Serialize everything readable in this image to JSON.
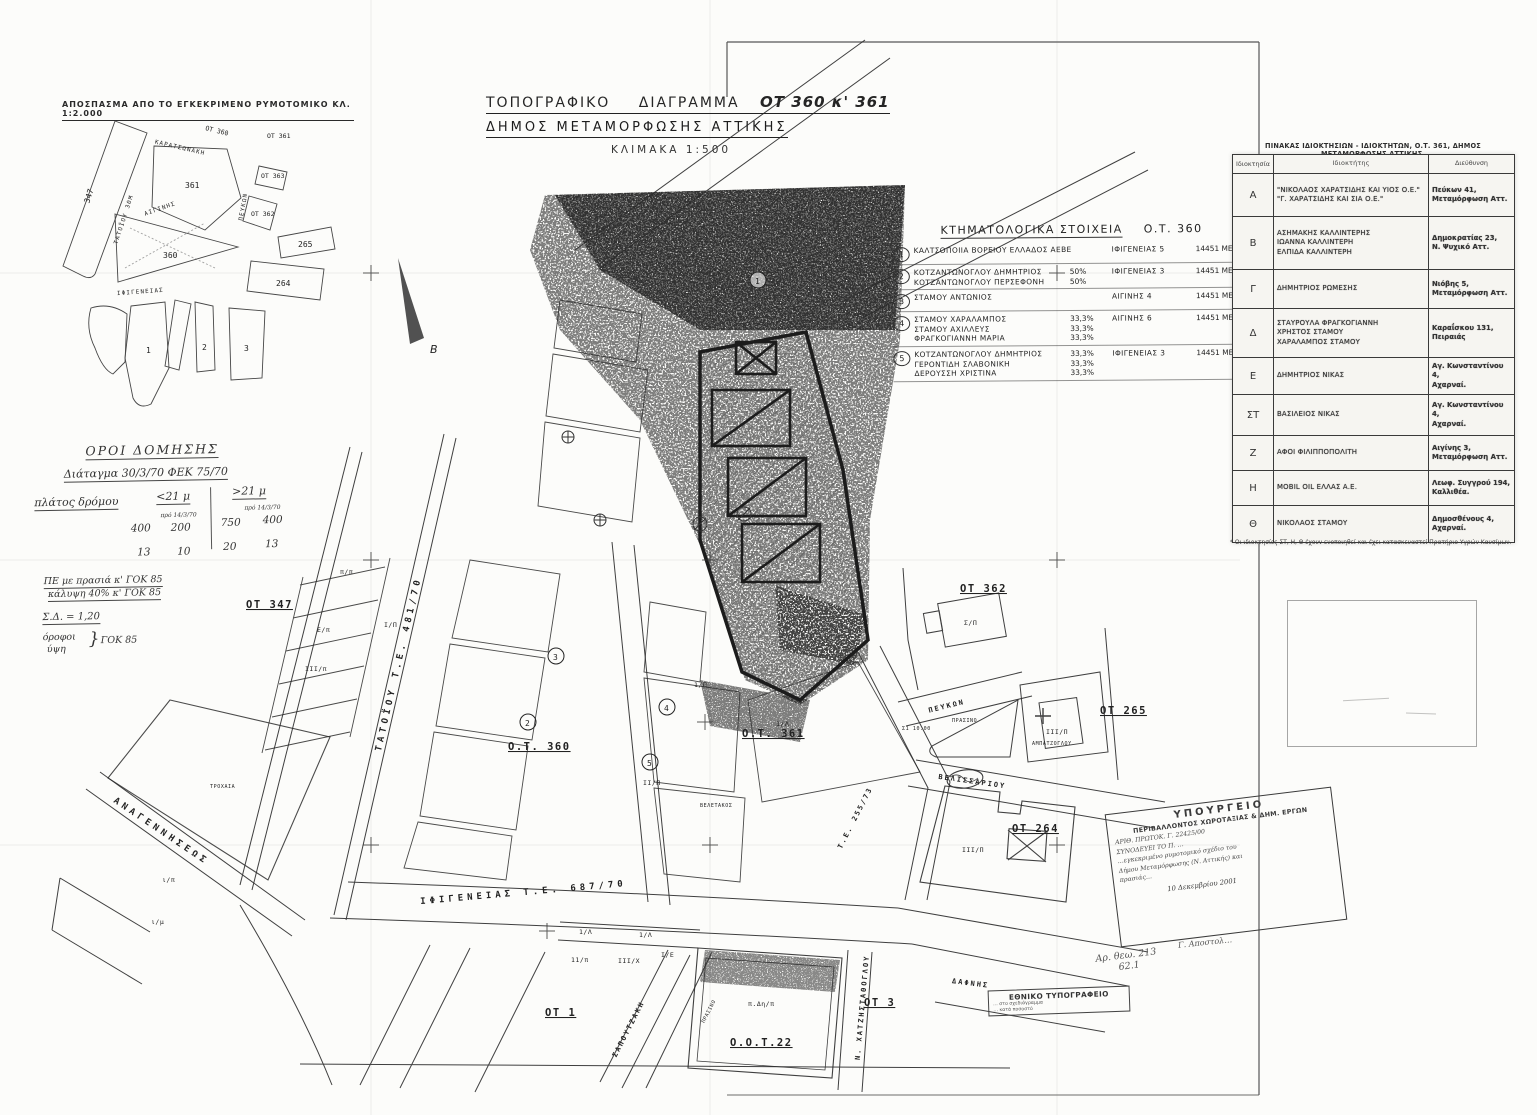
{
  "doc": {
    "extract_title": "ΑΠΟΣΠΑΣΜΑ ΑΠΟ ΤΟ ΕΓΚΕΚΡΙΜΕΝΟ ΡΥΜΟΤΟΜΙΚΟ ΚΛ. 1:2.000",
    "title_word1": "ΤΟΠΟΓΡΑΦΙΚΟ",
    "title_word2": "ΔΙΑΓΡΑΜΜΑ",
    "title_ot": "ΟΤ 360 κ' 361",
    "subtitle": "ΔΗΜΟΣ ΜΕΤΑΜΟΡΦΩΣΗΣ ΑΤΤΙΚΗΣ",
    "scale": "ΚΛΙΜΑΚΑ 1:500"
  },
  "inset": {
    "blocks": {
      "b347": "347",
      "b361": "361",
      "b360": "360",
      "b265": "265",
      "b264": "264",
      "b1": "1",
      "b2": "2",
      "b3": "3",
      "ot360": "ΟΤ 360",
      "ot361": "ΟΤ 361",
      "ot363": "ΟΤ 363",
      "ot362": "ΟΤ 362"
    },
    "streets": {
      "karatsonaki": "ΚΑΡΑΤΣΩΝΑΚΗ",
      "tatoiou": "ΤΑΤΟΪΟΥ 30Μ",
      "aiginis": "ΑΙΓΙΝΗΣ",
      "ifigeneias": "ΙΦΙΓΕΝΕΙΑΣ",
      "peukon": "ΠΕΥΚΩΝ"
    }
  },
  "oroi": {
    "title": "ΟΡΟΙ ΔΟΜΗΣΗΣ",
    "decree": "Διάταγμα 30/3/70 ΦΕΚ 75/70",
    "width_label": "πλάτος δρόμου",
    "col_lt": "<21 μ",
    "col_gt": ">21 μ",
    "sub_lt": "πρό 14/3/70",
    "sub_gt": "πρό 14/3/70",
    "v11": "400",
    "v12": "200",
    "v13": "750",
    "v14": "400",
    "v21": "13",
    "v22": "10",
    "v23": "20",
    "v24": "13",
    "note1": "ΠΕ με πρασιά κ' ΓΟΚ 85",
    "note2": "κάλυψη 40% κ' ΓΟΚ 85",
    "note3": "Σ.Δ. = 1,20",
    "note4a": "όροφοι",
    "note4b": "ύψη",
    "note4brace": "}",
    "note4c": "ΓΟΚ 85"
  },
  "cadastral": {
    "title": "ΚΤΗΜΑΤΟΛΟΓΙΚΑ ΣΤΟΙΧΕΙΑ",
    "title_ot": "Ο.Τ. 360",
    "entries": [
      {
        "num": "1",
        "lines": [
          "ΚΑΛΤΣΟΠΟΙΙΑ ΒΟΡΕΙΟΥ ΕΛΛΑΔΟΣ ΑΕΒΕ"
        ],
        "pcts": [],
        "address": "ΙΦΙΓΕΝΕΙΑΣ 5",
        "ref": "14451 ΜΕΤ/ΣΗ"
      },
      {
        "num": "2",
        "lines": [
          "ΚΟΤΖΑΝΤΩΝΟΓΛΟΥ ΔΗΜΗΤΡΙΟΣ",
          "ΚΟΤΖΑΝΤΩΝΟΓΛΟΥ ΠΕΡΣΕΦΟΝΗ"
        ],
        "pcts": [
          "50%",
          "50%"
        ],
        "address": "ΙΦΙΓΕΝΕΙΑΣ 3",
        "ref": "14451 ΜΕΤ/ΣΗ"
      },
      {
        "num": "3",
        "lines": [
          "ΣΤΑΜΟΥ ΑΝΤΩΝΙΟΣ"
        ],
        "pcts": [],
        "address": "ΑΙΓΙΝΗΣ 4",
        "ref": "14451 ΜΕΤ/ΣΗ"
      },
      {
        "num": "4",
        "lines": [
          "ΣΤΑΜΟΥ ΧΑΡΑΛΑΜΠΟΣ",
          "ΣΤΑΜΟΥ ΑΧΙΛΛΕΥΣ",
          "ΦΡΑΓΚΟΓΙΑΝΝΗ ΜΑΡΙΑ"
        ],
        "pcts": [
          "33,3%",
          "33,3%",
          "33,3%"
        ],
        "address": "ΑΙΓΙΝΗΣ 6",
        "ref": "14451 ΜΕΤ/ΣΗ"
      },
      {
        "num": "5",
        "lines": [
          "ΚΟΤΖΑΝΤΩΝΟΓΛΟΥ ΔΗΜΗΤΡΙΟΣ",
          "ΓΕΡΟΝΤΙΔΗ ΣΛΑΒΟΝΙΚΗ",
          "ΔΕΡΟΥΣΣΗ ΧΡΙΣΤΙΝΑ"
        ],
        "pcts": [
          "33,3%",
          "33,3%",
          "33,3%"
        ],
        "address": "ΙΦΙΓΕΝΕΙΑΣ 3",
        "ref": "14451 ΜΕΤ/ΣΗ"
      }
    ]
  },
  "owners_table": {
    "title": "ΠΙΝΑΚΑΣ ΙΔΙΟΚΤΗΣΙΩΝ - ΙΔΙΟΚΤΗΤΩΝ, Ο.Τ. 361, ΔΗΜΟΣ ΜΕΤΑΜΟΡΦΩΣΗΣ ΑΤΤΙΚΗΣ.",
    "col_id": "Ιδιοκτησία",
    "col_owner": "Ιδιοκτήτης",
    "col_addr": "Διεύθυνση",
    "rows": [
      {
        "id": "Α",
        "owners": [
          "\"ΝΙΚΟΛΑΟΣ ΧΑΡΑΤΣΙΔΗΣ ΚΑΙ ΥΙΟΣ Ο.Ε.\"",
          "\"Γ. ΧΑΡΑΤΣΙΔΗΣ ΚΑΙ ΣΙΑ Ο.Ε.\""
        ],
        "addr": [
          "Πεύκων 41,",
          "Μεταμόρφωση Αττ."
        ]
      },
      {
        "id": "Β",
        "owners": [
          "ΑΣΗΜΑΚΗΣ ΚΑΛΛΙΝΤΕΡΗΣ",
          "ΙΩΑΝΝΑ ΚΑΛΛΙΝΤΕΡΗ",
          "ΕΛΠΙΔΑ ΚΑΛΛΙΝΤΕΡΗ"
        ],
        "addr": [
          "Δημοκρατίας 23,",
          "Ν. Ψυχικό Αττ."
        ]
      },
      {
        "id": "Γ",
        "owners": [
          "ΔΗΜΗΤΡΙΟΣ ΡΩΜΕΣΗΣ"
        ],
        "addr": [
          "Νιόβης 5,",
          "Μεταμόρφωση Αττ."
        ]
      },
      {
        "id": "Δ",
        "owners": [
          "ΣΤΑΥΡΟΥΛΑ ΦΡΑΓΚΟΓΙΑΝΝΗ",
          "ΧΡΗΣΤΟΣ ΣΤΑΜΟΥ",
          "ΧΑΡΑΛΑΜΠΟΣ ΣΤΑΜΟΥ"
        ],
        "addr": [
          "Καραΐσκου 131,",
          "Πειραιάς"
        ]
      },
      {
        "id": "Ε",
        "owners": [
          "ΔΗΜΗΤΡΙΟΣ ΝΙΚΑΣ"
        ],
        "addr": [
          "Αγ. Κωνσταντίνου 4,",
          "Αχαρναί."
        ]
      },
      {
        "id": "ΣΤ",
        "owners": [
          "ΒΑΣΙΛΕΙΟΣ ΝΙΚΑΣ"
        ],
        "addr": [
          "Αγ. Κωνσταντίνου 4,",
          "Αχαρναί."
        ]
      },
      {
        "id": "Ζ",
        "owners": [
          "ΑΦΟΙ ΦΙΛΙΠΠΟΠΟΛΙΤΗ"
        ],
        "addr": [
          "Αιγίνης 3,",
          "Μεταμόρφωση Αττ."
        ]
      },
      {
        "id": "Η",
        "owners": [
          "MOBIL OIL ΕΛΛΑΣ Α.Ε."
        ],
        "addr": [
          "Λεωφ. Συγγρού 194,",
          "Καλλιθέα."
        ]
      },
      {
        "id": "Θ",
        "owners": [
          "ΝΙΚΟΛΑΟΣ ΣΤΑΜΟΥ"
        ],
        "addr": [
          "Δημοσθένους 4,",
          "Αχαρναί."
        ]
      }
    ],
    "footnote": "* Οι ιδιοκτησίες ΣΤ, Η, Θ έχουν ενοποιηθεί και έχει κατασκευαστεί Πρατήριο Υγρών Καυσίμων."
  },
  "map": {
    "streets": {
      "tatoiou": "ΤΑΤΟΪΟΥ  Τ.Ε. 481/70",
      "anagenniseos": "ΑΝΑΓΕΝΝΗΣΕΩΣ",
      "ifigeneias": "ΙΦΙΓΕΝΕΙΑΣ   Τ.Ε. 687/70",
      "peukon": "ΠΕΥΚΩΝ",
      "velissariou": "ΒΕΛΙΣΣΑΡΙΟΥ",
      "te25573": "Τ.Ε. 255/73",
      "sapoutzaki": "ΣΑΠΟΥΤΖΑΚΗ",
      "chatzistathoglou": "Ν. ΧΑΤΖΗΣΤΑΘΟΓΛΟΥ",
      "dafnis": "ΔΑΦΝΗΣ"
    },
    "blocks": {
      "ot347": "ΟΤ 347",
      "ot360": "Ο.Τ. 360",
      "ot361": "Ο.Τ. 361",
      "ot362": "ΟΤ 362",
      "ot265": "ΟΤ 265",
      "ot264": "ΟΤ 264",
      "ot3": "ΟΤ 3",
      "ot1": "ΟΤ 1",
      "oot22": "Ο.Ο.Τ.22"
    },
    "annotations": {
      "prasino1": "ΠΡΑΣΙΝΟ",
      "prasino2": "ΠΡΑΣΙΝΟ",
      "trochaia": "ΤΡΟΧΑΙΑ",
      "veletakos": "ΒΕΛΕΤΑΚΟΣ",
      "ampatzoglou": "ΑΜΠΑΤΖΟΓΛΟΥ",
      "s1": "Σ1 10.00",
      "north": "Β"
    },
    "parcels": {
      "p1": "π/π",
      "p2": "Ε/π",
      "p3": "ΙΙΙ/π",
      "p4": "ι/π",
      "p5": "ι/μ",
      "p6": "Ι/Π",
      "p7": "1/Π",
      "p8": "ΙΙ/Π",
      "p9": "1/Λ",
      "p10": "1/Λ",
      "p11": "11/π",
      "p12": "ΙΙΙ/Χ",
      "p13": "Ι/Ε",
      "p14": "ΙΙΙ/Π",
      "p15": "Σ/Π",
      "p16": "π.Δη/π",
      "p17": "1/Λ",
      "p18": "ΙΙΙ/Π"
    },
    "circled": [
      "1",
      "2",
      "3",
      "4",
      "5"
    ]
  },
  "stamps": {
    "ministry": {
      "l1": "ΥΠΟΥΡΓΕΙΟ",
      "l2": "ΠΕΡΙΒΑΛΛΟΝΤΟΣ ΧΩΡΟΤΑΞΙΑΣ & ΔΗΜ. ΕΡΓΩΝ",
      "l3": "ΑΡΙΘ. ΠΡΩΤΟΚ.  Γ. 22425/00",
      "l4": "ΣΥΝΟΔΕΥΕΙ ΤΟ Π. …",
      "l5": "…εγκεκριμένο ρυμοτομικό σχέδιο του",
      "l6": "Δήμου Μεταμόρφωσης (Ν. Αττικής) και",
      "l7": "πρασιάς…",
      "date": "10 Δεκεμβρίου 2001",
      "sig": "Γ. Αποστολ…"
    },
    "handnote1": "Αρ. θεω. 213",
    "handnote2": "62.1",
    "printing": {
      "l1": "ΕΘΝΙΚΟ ΤΥΠΟΓΡΑΦΕΙΟ",
      "l2": "… στο σχεδιάγραμμα",
      "l3": "… κατά ποσοστό"
    }
  }
}
